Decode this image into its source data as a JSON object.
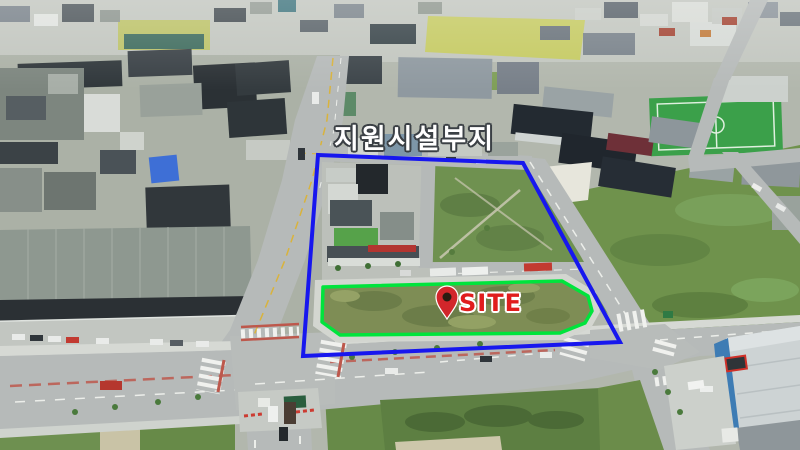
{
  "annotations": {
    "district_label": {
      "text": "지원시설부지",
      "color": "#ffffff",
      "outline_color": "#3b4045"
    },
    "outer_boundary": {
      "color": "#1717ee",
      "stroke_width": 4,
      "points": [
        [
          318,
          155
        ],
        [
          523,
          163
        ],
        [
          620,
          342
        ],
        [
          303,
          356
        ]
      ]
    },
    "site_boundary": {
      "color": "#00e43c",
      "stroke_width": 3.5,
      "points": [
        [
          323,
          287
        ],
        [
          562,
          281
        ],
        [
          588,
          296
        ],
        [
          592,
          311
        ],
        [
          585,
          323
        ],
        [
          560,
          333
        ],
        [
          340,
          335
        ],
        [
          322,
          322
        ]
      ]
    },
    "site_label": {
      "text": "SITE",
      "color": "#e01d1d",
      "outline_color": "#ffffff"
    },
    "site_pin": {
      "color": "#d2262b",
      "hole_color": "#2a1c11",
      "outline_color": "#ffffff",
      "cx": 447,
      "cy": 297,
      "tip_y": 319,
      "radius": 11
    }
  }
}
